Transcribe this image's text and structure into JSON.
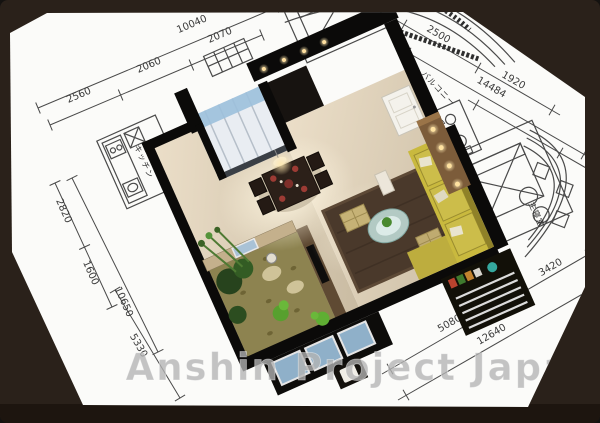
{
  "watermark": {
    "text": "Anshin Project Japan"
  },
  "floorplan": {
    "room_labels": {
      "kitchen": "キッチン",
      "bedroom": "寝室",
      "balcony": "バルコニー",
      "bathroom": "バスルーム",
      "master_bedroom": "主寝室"
    },
    "dimensions": {
      "top_overall": "10040",
      "top_segments": [
        "2560",
        "2060",
        "2070"
      ],
      "left_segments": [
        "2820",
        "1600"
      ],
      "left_overall": "10650",
      "left_lower": "5330",
      "right_inner": [
        "2500",
        "1920"
      ],
      "right_overall": "14484",
      "bottom_inner": [
        "5080",
        "3420"
      ],
      "bottom_overall": "12640"
    }
  },
  "colors": {
    "frame": "#2a211a",
    "frame_bottom": "#1d150f",
    "paper": "#fbfbf9",
    "plan_line": "#4a4a4a",
    "dim_text": "#3a3a3a",
    "wall": "#0b0a09",
    "floor_light": "#ecdfc9",
    "floor_dark": "#c9bba2",
    "sofa": "#c9b93e",
    "rug": "#4a392b",
    "garden": "#8d8350",
    "glass_table": "#bcd7d2",
    "closet_glow": "#9cc0dc",
    "counter_wood": "#7c5c3a",
    "watermark": "#b4b4b4"
  }
}
